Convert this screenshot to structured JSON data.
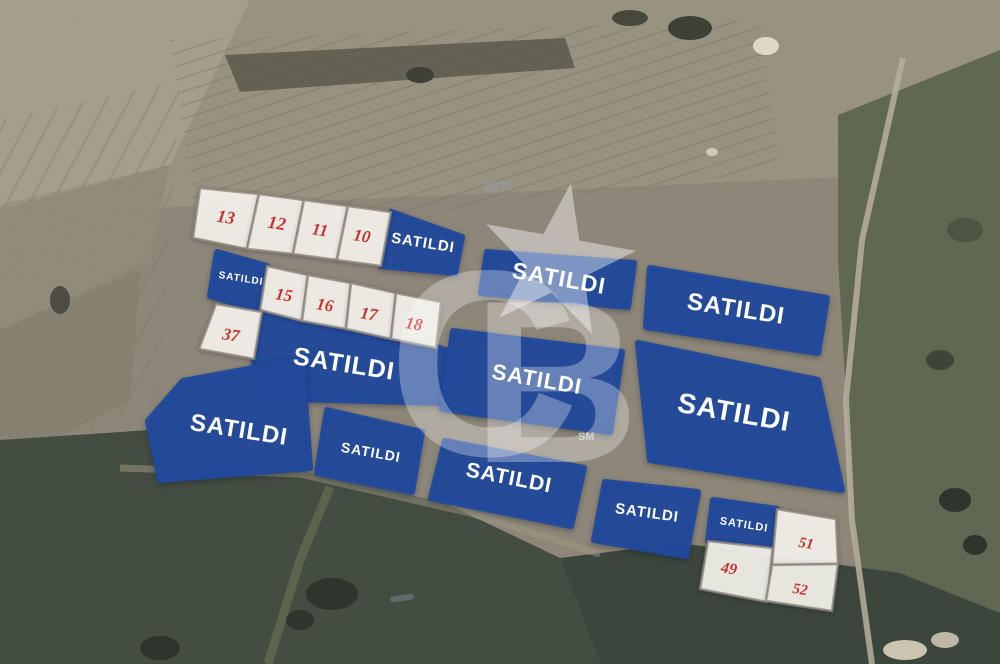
{
  "canvas": {
    "width": 1000,
    "height": 664
  },
  "colors": {
    "parcel_blue": "#21499b",
    "lot_white": "#f6f4ee",
    "lot_stroke": "#8d8679",
    "number_red": "#c7342f",
    "label_white": "#ffffff",
    "watermark_white": "#ffffff"
  },
  "sold_label": "SATILDI",
  "parcels": [
    {
      "id": "sold-row1",
      "kind": "sold",
      "label": "SATILDI",
      "points": "391,212 462,237 455,273 381,266",
      "lx": 423,
      "ly": 243,
      "rot": 9,
      "fs": 15
    },
    {
      "id": "sold-row2-left",
      "kind": "sold",
      "label": "SATILDI",
      "points": "217,252 267,266 260,310 210,296",
      "lx": 241,
      "ly": 279,
      "rot": 9,
      "fs": 10
    },
    {
      "id": "sold-row2-main",
      "kind": "sold",
      "label": "SATILDI",
      "points": "262,312 436,347 452,352 448,403 258,398 254,359",
      "lx": 344,
      "ly": 364,
      "rot": 9,
      "fs": 25
    },
    {
      "id": "sold-top-middle",
      "kind": "sold",
      "label": "SATILDI",
      "points": "487,252 634,263 628,307 481,293",
      "lx": 559,
      "ly": 278,
      "rot": 10,
      "fs": 23
    },
    {
      "id": "sold-top-right",
      "kind": "sold",
      "label": "SATILDI",
      "points": "650,268 827,298 818,353 646,327",
      "lx": 736,
      "ly": 309,
      "rot": 9,
      "fs": 24
    },
    {
      "id": "sold-center",
      "kind": "sold",
      "label": "SATILDI",
      "points": "453,331 622,352 610,432 442,409",
      "lx": 537,
      "ly": 379,
      "rot": 10,
      "fs": 22
    },
    {
      "id": "sold-right-large",
      "kind": "sold",
      "label": "SATILDI",
      "points": "638,343 818,380 842,490 650,460",
      "lx": 734,
      "ly": 412,
      "rot": 10,
      "fs": 28
    },
    {
      "id": "sold-bottom-left",
      "kind": "sold",
      "label": "SATILDI",
      "points": "183,381 302,359 310,468 160,480 148,421",
      "lx": 239,
      "ly": 430,
      "rot": 9,
      "fs": 24
    },
    {
      "id": "sold-bottom-small",
      "kind": "sold",
      "label": "SATILDI",
      "points": "327,410 422,432 412,492 317,473",
      "lx": 371,
      "ly": 452,
      "rot": 10,
      "fs": 14
    },
    {
      "id": "sold-bottom-center",
      "kind": "sold",
      "label": "SATILDI",
      "points": "445,441 584,468 571,526 431,498",
      "lx": 509,
      "ly": 478,
      "rot": 11,
      "fs": 21
    },
    {
      "id": "sold-bottom-right",
      "kind": "sold",
      "label": "SATILDI",
      "points": "605,482 698,492 686,556 594,540",
      "lx": 647,
      "ly": 513,
      "rot": 8,
      "fs": 15
    },
    {
      "id": "sold-group-corner",
      "kind": "sold",
      "label": "SATILDI",
      "points": "713,500 777,509 773,548 708,541",
      "lx": 744,
      "ly": 525,
      "rot": 9,
      "fs": 11
    },
    {
      "id": "lot-13",
      "kind": "lot",
      "label": "13",
      "points": "200,188 259,194 247,249 193,238",
      "lx": 226,
      "ly": 217,
      "rot": 9,
      "fs": 18
    },
    {
      "id": "lot-12",
      "kind": "lot",
      "label": "12",
      "points": "259,194 304,200 293,254 247,249",
      "lx": 277,
      "ly": 223,
      "rot": 9,
      "fs": 18
    },
    {
      "id": "lot-11",
      "kind": "lot",
      "label": "11",
      "points": "304,200 348,206 337,260 293,254",
      "lx": 320,
      "ly": 230,
      "rot": 9,
      "fs": 17
    },
    {
      "id": "lot-10",
      "kind": "lot",
      "label": "10",
      "points": "348,206 391,212 381,266 337,260",
      "lx": 362,
      "ly": 236,
      "rot": 9,
      "fs": 17
    },
    {
      "id": "lot-15",
      "kind": "lot",
      "label": "15",
      "points": "267,266 308,275 302,321 260,310",
      "lx": 284,
      "ly": 295,
      "rot": 9,
      "fs": 17
    },
    {
      "id": "lot-16",
      "kind": "lot",
      "label": "16",
      "points": "308,275 351,283 346,329 302,321",
      "lx": 325,
      "ly": 305,
      "rot": 9,
      "fs": 17
    },
    {
      "id": "lot-17",
      "kind": "lot",
      "label": "17",
      "points": "351,283 396,293 391,339 346,329",
      "lx": 369,
      "ly": 314,
      "rot": 9,
      "fs": 17
    },
    {
      "id": "lot-18",
      "kind": "lot",
      "label": "18",
      "points": "396,293 441,302 436,348 391,339",
      "lx": 414,
      "ly": 324,
      "rot": 9,
      "fs": 17
    },
    {
      "id": "lot-37",
      "kind": "lot",
      "label": "37",
      "points": "216,304 262,312 254,359 199,349",
      "lx": 231,
      "ly": 335,
      "rot": 9,
      "fs": 17
    },
    {
      "id": "lot-49",
      "kind": "lot",
      "label": "49",
      "points": "708,541 773,548 767,602 700,589",
      "lx": 729,
      "ly": 569,
      "rot": 9,
      "fs": 16
    },
    {
      "id": "lot-51",
      "kind": "lot",
      "label": "51",
      "points": "777,509 836,519 838,564 772,565",
      "lx": 806,
      "ly": 544,
      "rot": 9,
      "fs": 15
    },
    {
      "id": "lot-52",
      "kind": "lot",
      "label": "52",
      "points": "772,565 838,564 832,611 766,601",
      "lx": 800,
      "ly": 590,
      "rot": 9,
      "fs": 15
    }
  ],
  "watermark": {
    "letter_c": "C",
    "letter_b": "B",
    "service_mark": "SM"
  },
  "map_labels": [
    {
      "text": "15/16",
      "x": 498,
      "y": 190
    }
  ]
}
